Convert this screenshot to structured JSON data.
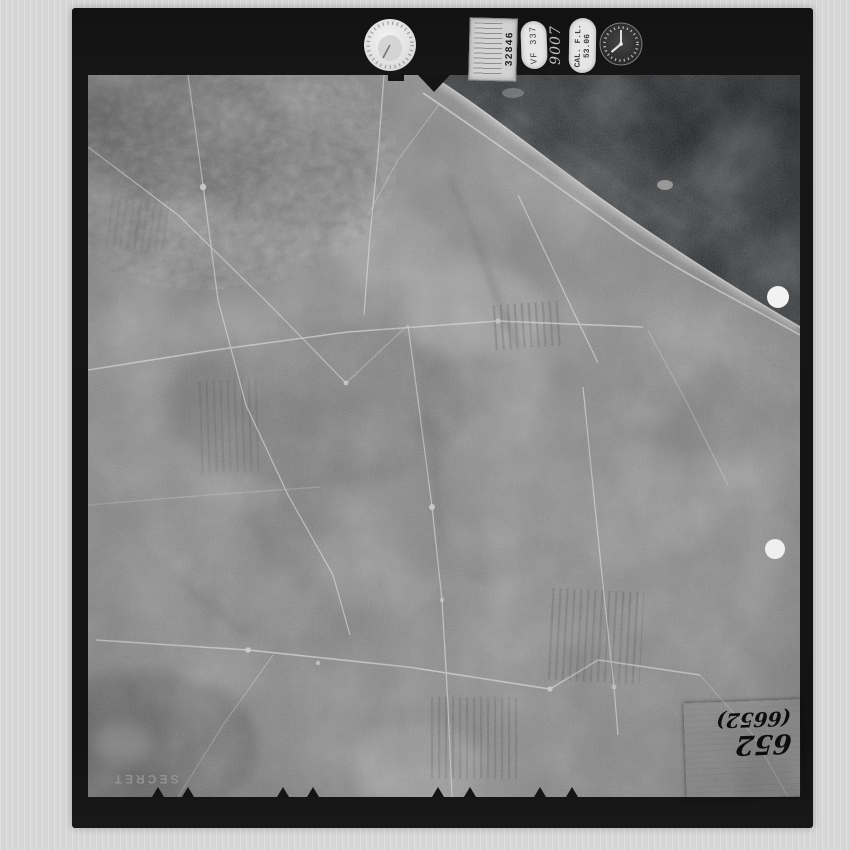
{
  "meta": {
    "description": "Scanned black-and-white aerial reconnaissance film frame showing coastal farmland with field patterns, roads and shoreline",
    "classification_visible": true
  },
  "colors": {
    "scanner_background": "#d9d9d9",
    "film_border": "#141414",
    "photo_base": "#868686",
    "sea": "#24272a",
    "shoreline_highlight": "#c4c4c4",
    "punch_hole": "#f2f2f2",
    "label_patch": "#f4f4f4",
    "handwriting_ink": "#0d0d0d",
    "secret_text": "#979797"
  },
  "stamps": {
    "dial_icon": "altimeter-dial-stamp",
    "clock_icon": "clock-stamp",
    "data_block_number": "32846",
    "oval_stamp_1": "VF 337",
    "handwritten_code": "9007",
    "calibration_line1": "CAL. F.L.",
    "calibration_line2": "53.06"
  },
  "markings": {
    "security_label": "SECRET",
    "frame_number": "652",
    "frame_number_paren": "(6652)"
  },
  "photo_features": {
    "sea_position": "top-right",
    "punch_holes": 2,
    "forest_area": "top-left",
    "label_patch_position": "bottom-right"
  }
}
